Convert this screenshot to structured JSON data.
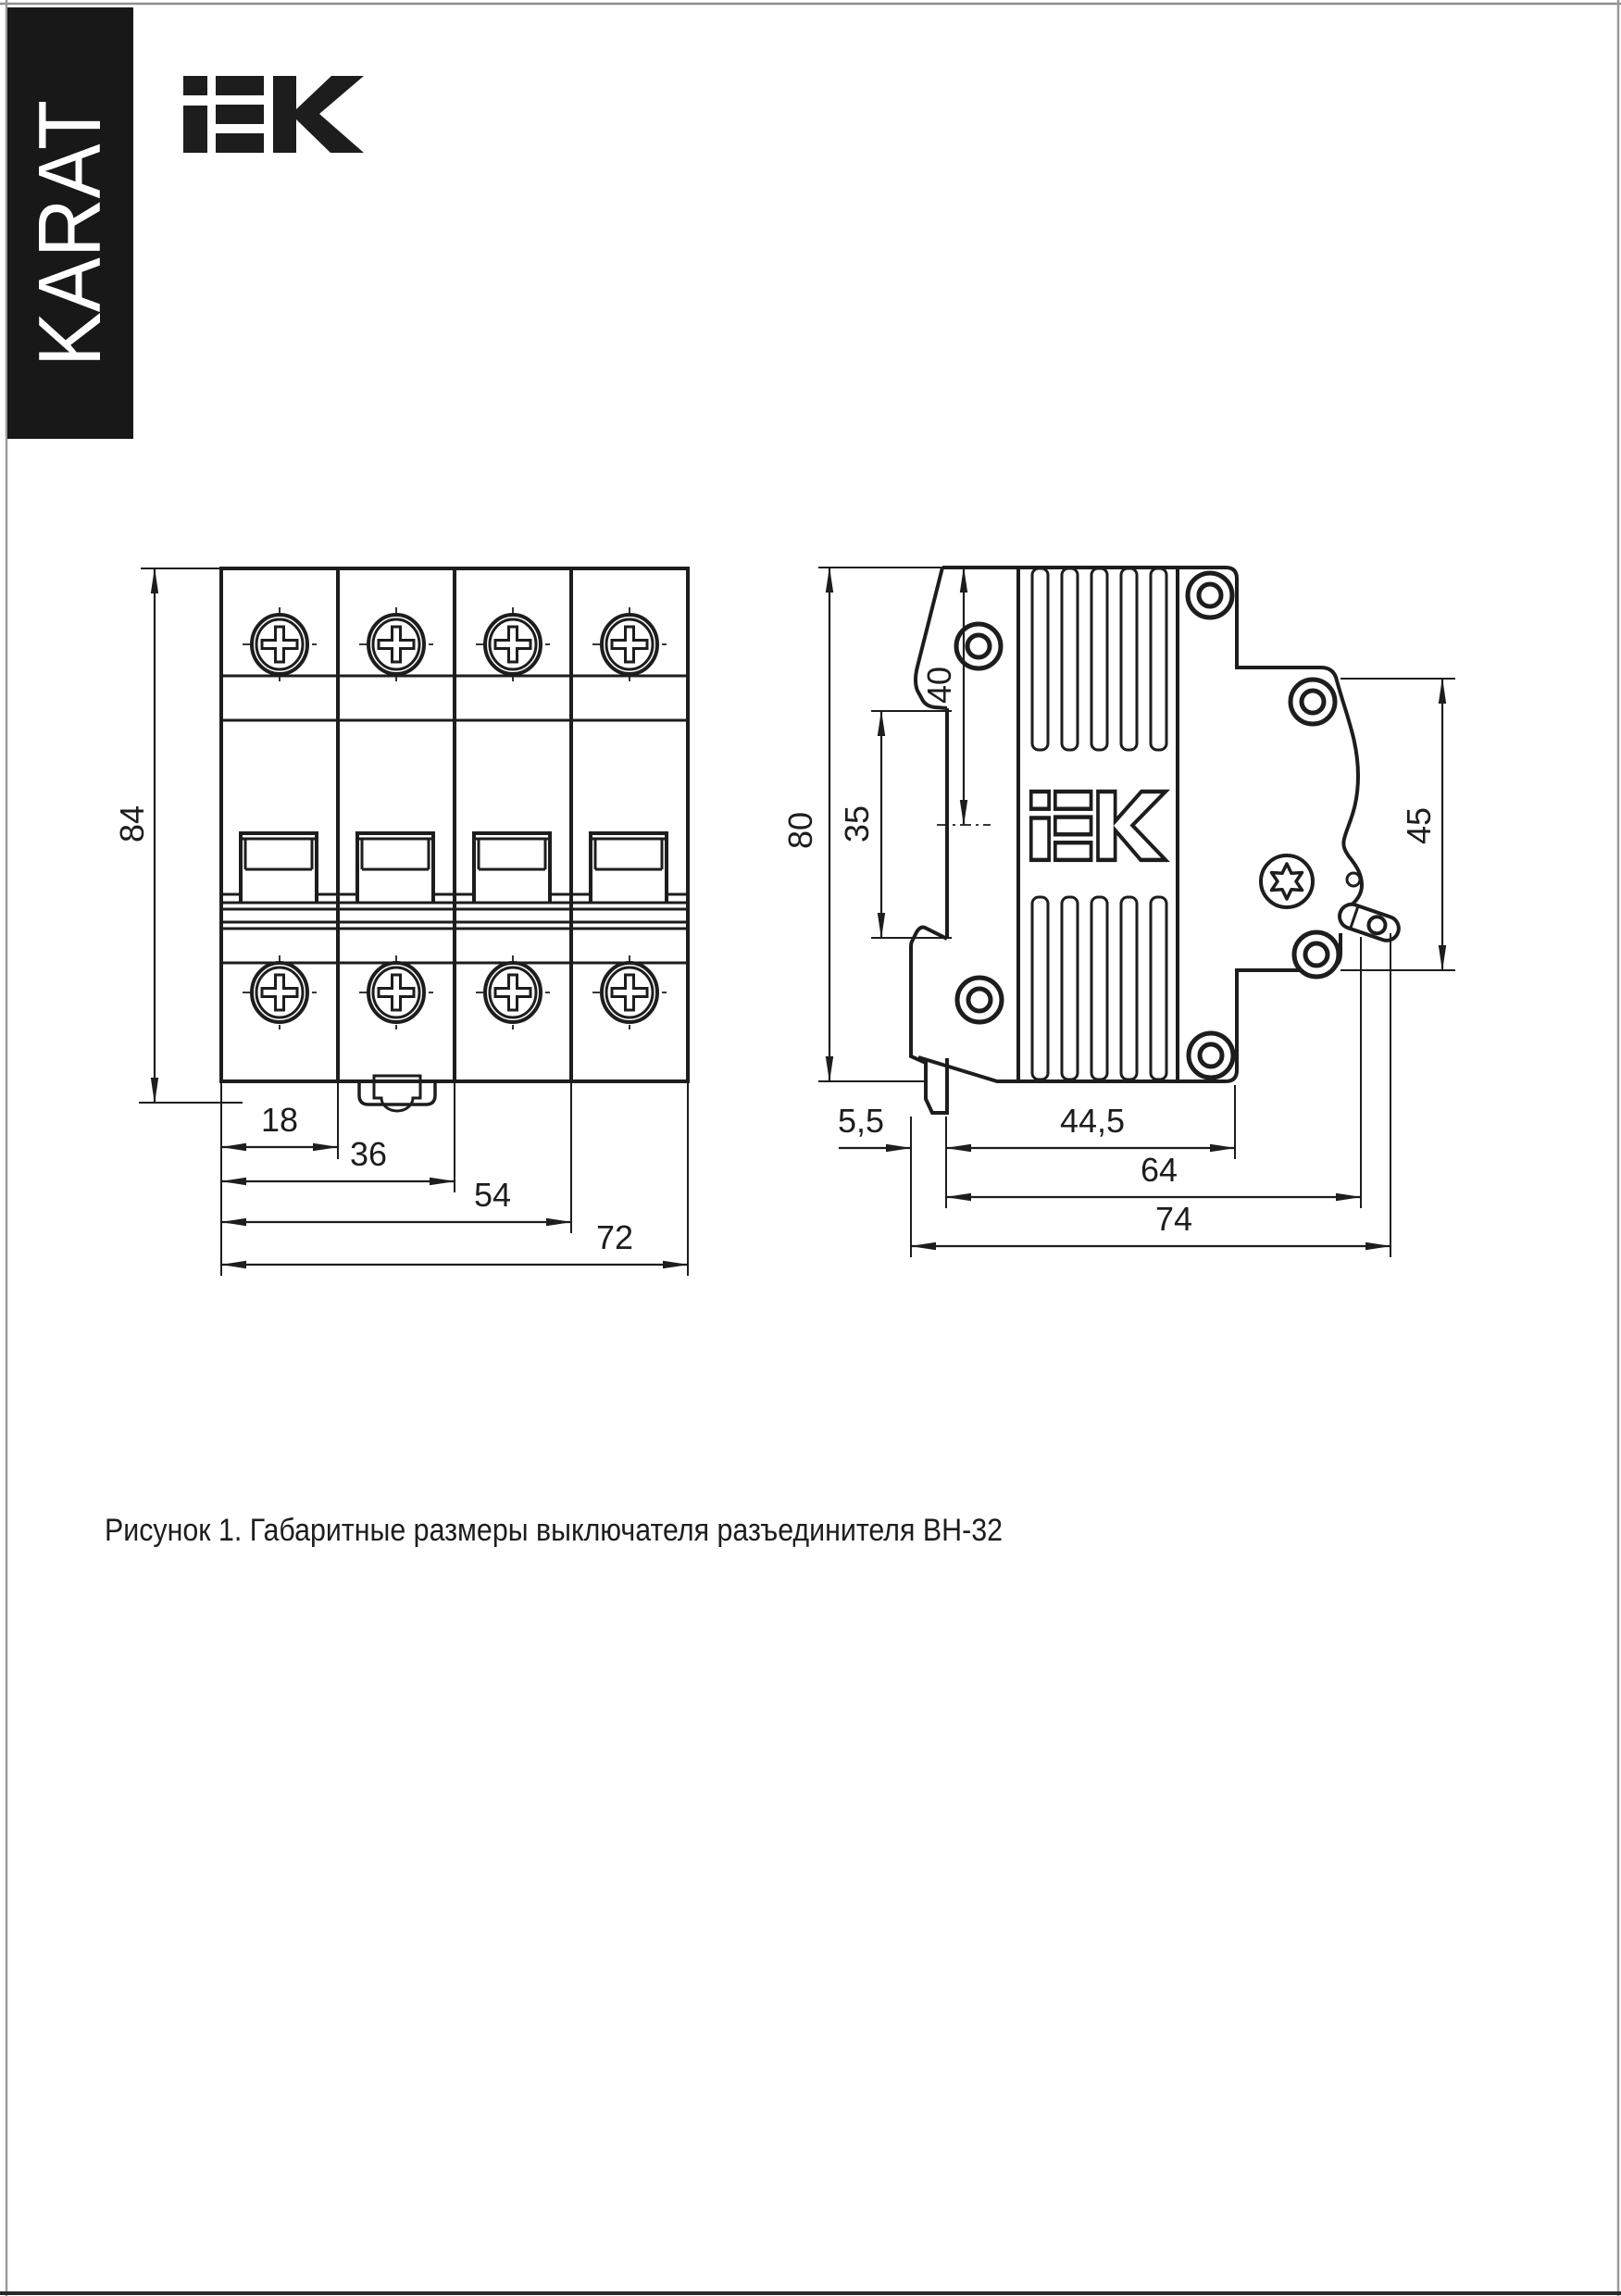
{
  "page": {
    "background": "#ffffff",
    "line_color": "#1d1d1d",
    "border_color": "#999999"
  },
  "banner": {
    "label": "KARAT",
    "bg": "#181818",
    "fg": "#ffffff"
  },
  "header": {
    "logo_text": "iEK"
  },
  "figure": {
    "caption": "Рисунок 1. Габаритные размеры выключателя разъединителя ВН-32",
    "front_view": {
      "description": "front view of 4-pole switch-disconnector",
      "poles": 4,
      "dims": {
        "height": "84",
        "pole": "18",
        "two_poles": "36",
        "three_poles": "54",
        "width": "72"
      }
    },
    "side_view": {
      "description": "side view of switch-disconnector",
      "embossed_logo": "iEK",
      "dims": {
        "height": "80",
        "din_rail": "35",
        "top_to_rail": "40",
        "front_height": "45",
        "clip": "5,5",
        "base": "44,5",
        "depth_body": "64",
        "depth_total": "74"
      }
    }
  }
}
